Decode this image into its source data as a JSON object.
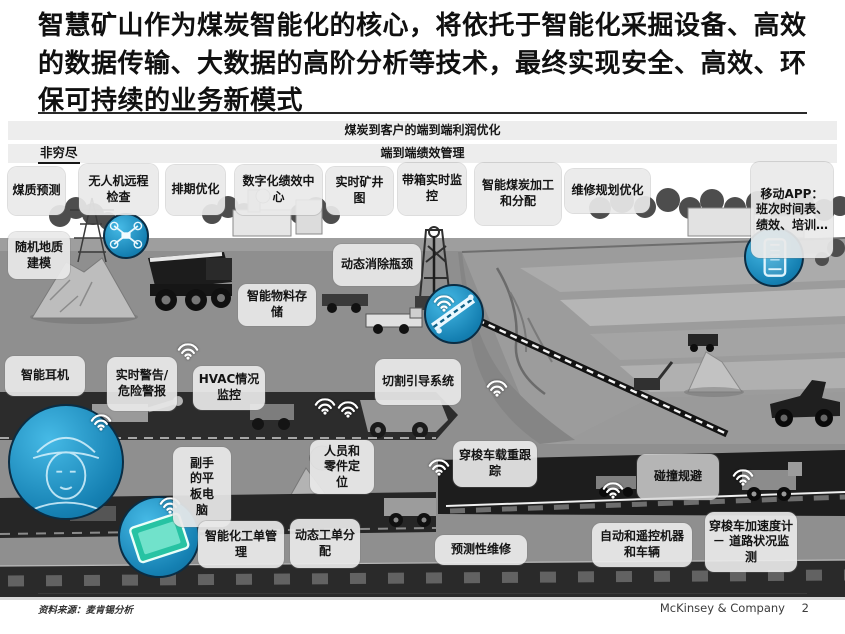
{
  "title": "智慧矿山作为煤炭智能化的核心，将依托于智能化采掘设备、高效的数据传输、大数据的高阶分析等技术，最终实现安全、高效、环保可持续的业务新模式",
  "banner": {
    "profit_bar": "煤炭到客户的端到端利润优化",
    "performance_bar": "端到端绩效管理",
    "note": "非穷尽"
  },
  "callouts": [
    {
      "id": "coal-quality-prediction",
      "label": "煤质预测"
    },
    {
      "id": "drone-remote-inspection",
      "label": "无人机远程检查"
    },
    {
      "id": "scheduling-optimization",
      "label": "排期优化"
    },
    {
      "id": "digital-performance-center",
      "label": "数字化绩效中心"
    },
    {
      "id": "realtime-mine-map",
      "label": "实时矿井图"
    },
    {
      "id": "belt-realtime-monitoring",
      "label": "带箱实时监控"
    },
    {
      "id": "smart-coal-processing",
      "label": "智能煤炭加工和分配"
    },
    {
      "id": "maintenance-planning",
      "label": "维修规划优化"
    },
    {
      "id": "mobile-app",
      "label": "移动APP：班次时间表、绩效、培训…"
    },
    {
      "id": "stochastic-geological-modeling",
      "label": "随机地质建模"
    },
    {
      "id": "dynamic-debottlenecking",
      "label": "动态消除瓶颈"
    },
    {
      "id": "smart-material-storage",
      "label": "智能物料存储"
    },
    {
      "id": "smart-headset",
      "label": "智能耳机"
    },
    {
      "id": "realtime-warning-alarm",
      "label": "实时警告/危险警报"
    },
    {
      "id": "hvac-monitoring",
      "label": "HVAC情况监控"
    },
    {
      "id": "cutting-guidance-system",
      "label": "切割引导系统"
    },
    {
      "id": "assistant-tablet",
      "label": "副手的平板电脑"
    },
    {
      "id": "personnel-parts-positioning",
      "label": "人员和零件定位"
    },
    {
      "id": "shuttle-load-tracking",
      "label": "穿梭车载重跟踪"
    },
    {
      "id": "collision-avoidance",
      "label": "碰撞规避"
    },
    {
      "id": "smart-workorder-management",
      "label": "智能化工单管理"
    },
    {
      "id": "dynamic-workorder-dispatch",
      "label": "动态工单分配"
    },
    {
      "id": "predictive-maintenance",
      "label": "预测性维修"
    },
    {
      "id": "auto-remote-machines-vehicles",
      "label": "自动和遥控机器和车辆"
    },
    {
      "id": "shuttle-accelerometer-road",
      "label": "穿梭车加速度计 － 道路状况监测"
    }
  ],
  "icons": {
    "wifi": "wifi-signal-icon",
    "closeups": [
      "drone-closeup",
      "conveyor-closeup",
      "smartphone-closeup",
      "miner-helmet-closeup",
      "tablet-closeup"
    ]
  },
  "colors": {
    "accent_blue": "#2aa9dc",
    "closeup_border": "#0a2d44",
    "box_bg": "#e9e9e9",
    "ground_gray": "#8f8f8f",
    "band_dark": "#2b2b2b"
  },
  "footer": {
    "source": "资料来源：麦肯锡分析",
    "brand": "McKinsey & Company",
    "page": "2"
  }
}
